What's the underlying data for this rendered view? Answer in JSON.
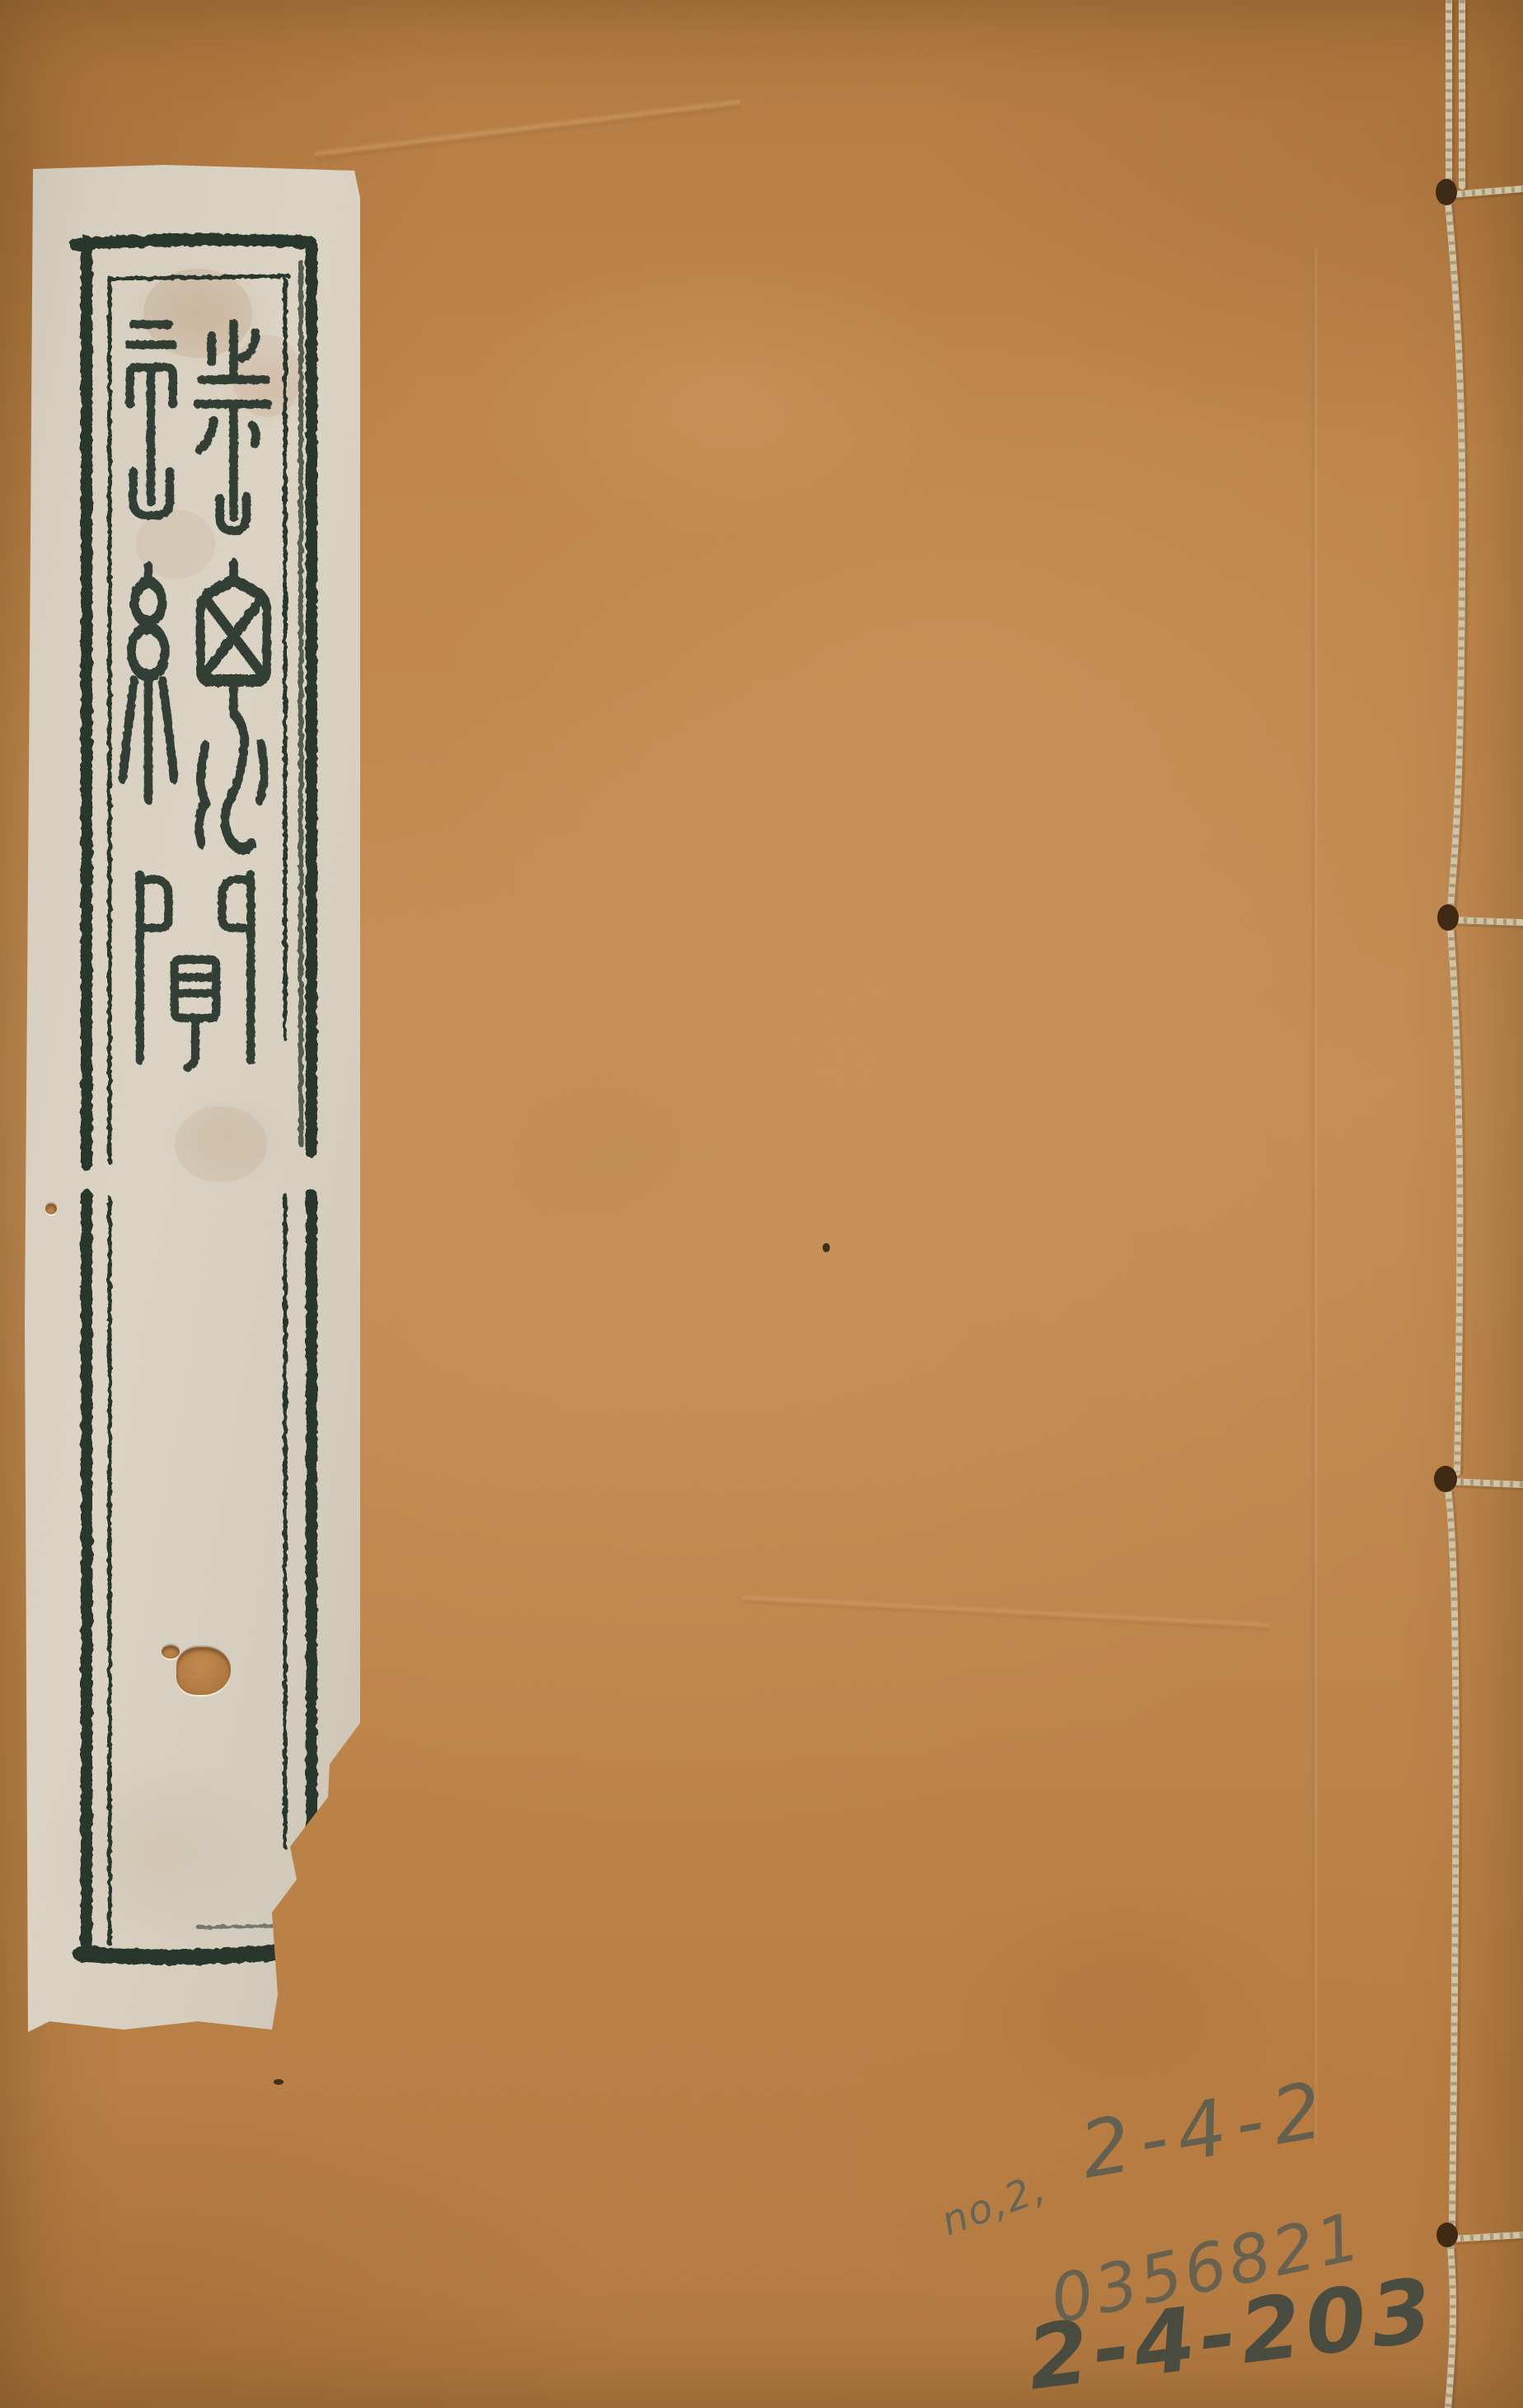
{
  "document": {
    "kind": "digitized thread-bound book cover",
    "binding_style": "four-hole stitched binding",
    "stitch_holes": 4
  },
  "title_label": {
    "title": "詩總聞",
    "script": "seal script",
    "characters": {
      "first": "詩",
      "second": "總",
      "third": "聞"
    }
  },
  "pencil_annotations": {
    "small_note": "no,2,",
    "shelf_mark_top": "2-4-2",
    "accession_number": "0356821",
    "shelf_mark_bottom": "2-4-203"
  },
  "colors": {
    "cover_paper": "#c08649",
    "label_paper": "#d9d2c4",
    "printed_ink": "#203029",
    "pencil": "#4d5852",
    "thread": "#d3c7a8"
  }
}
